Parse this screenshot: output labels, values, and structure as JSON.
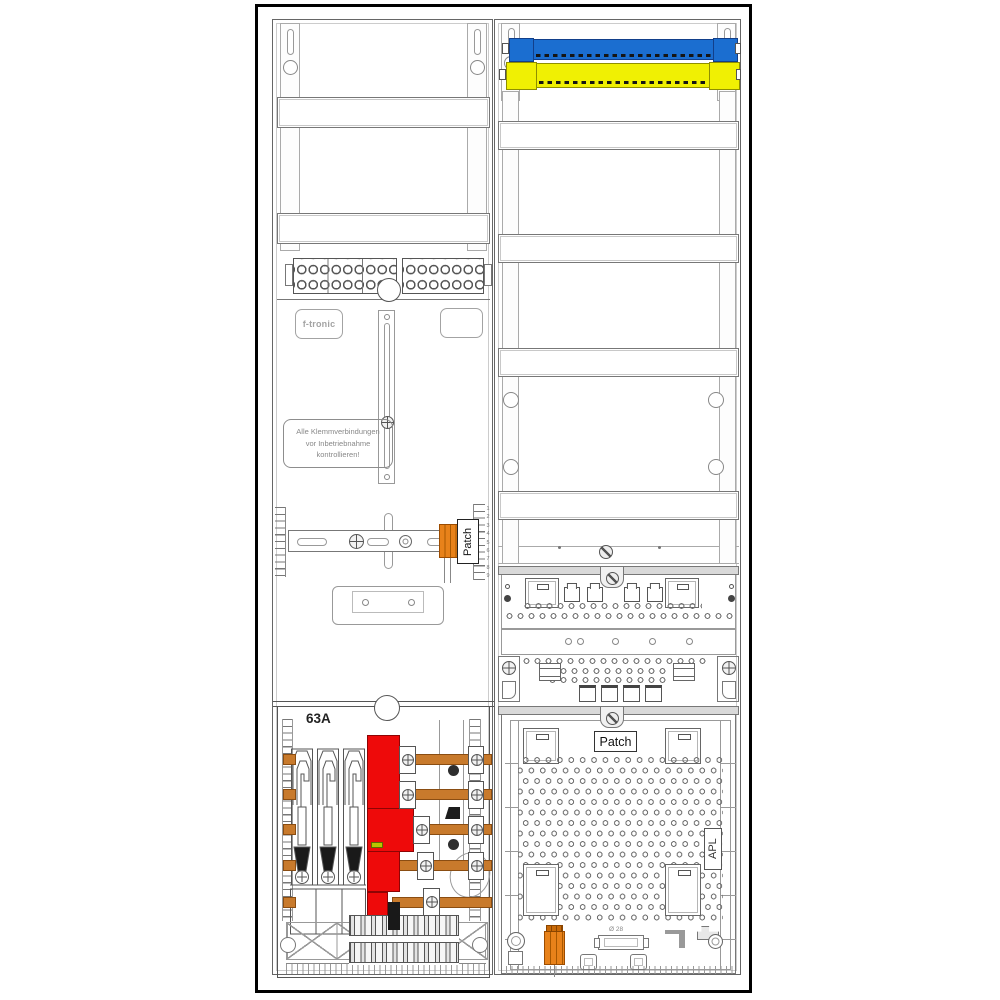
{
  "diagram": {
    "kind": "meter-cabinet-technical-drawing",
    "brand": "f-tronic",
    "labels": {
      "warning": [
        "Alle Klemmverbindungen",
        "vor Inbetriebnahme",
        "kontrollieren!"
      ],
      "patch_left": "Patch",
      "patch_right": "Patch",
      "apl": "APL",
      "rating": "63A",
      "cable_diameter": "Ø 28"
    },
    "ruler": {
      "numbers": [
        "1",
        "2",
        "3",
        "4",
        "5",
        "6",
        "7",
        "8",
        "9"
      ]
    },
    "colors": {
      "neutral_busbar_blue": "#1b6ed0",
      "pe_busbar_yellow": "#f0f003",
      "sls_switch_red": "#ee0a0a",
      "copper_busbar": "#c87a2c",
      "connector_orange": "#e8821a",
      "indicator_green": "#b9c400"
    }
  }
}
